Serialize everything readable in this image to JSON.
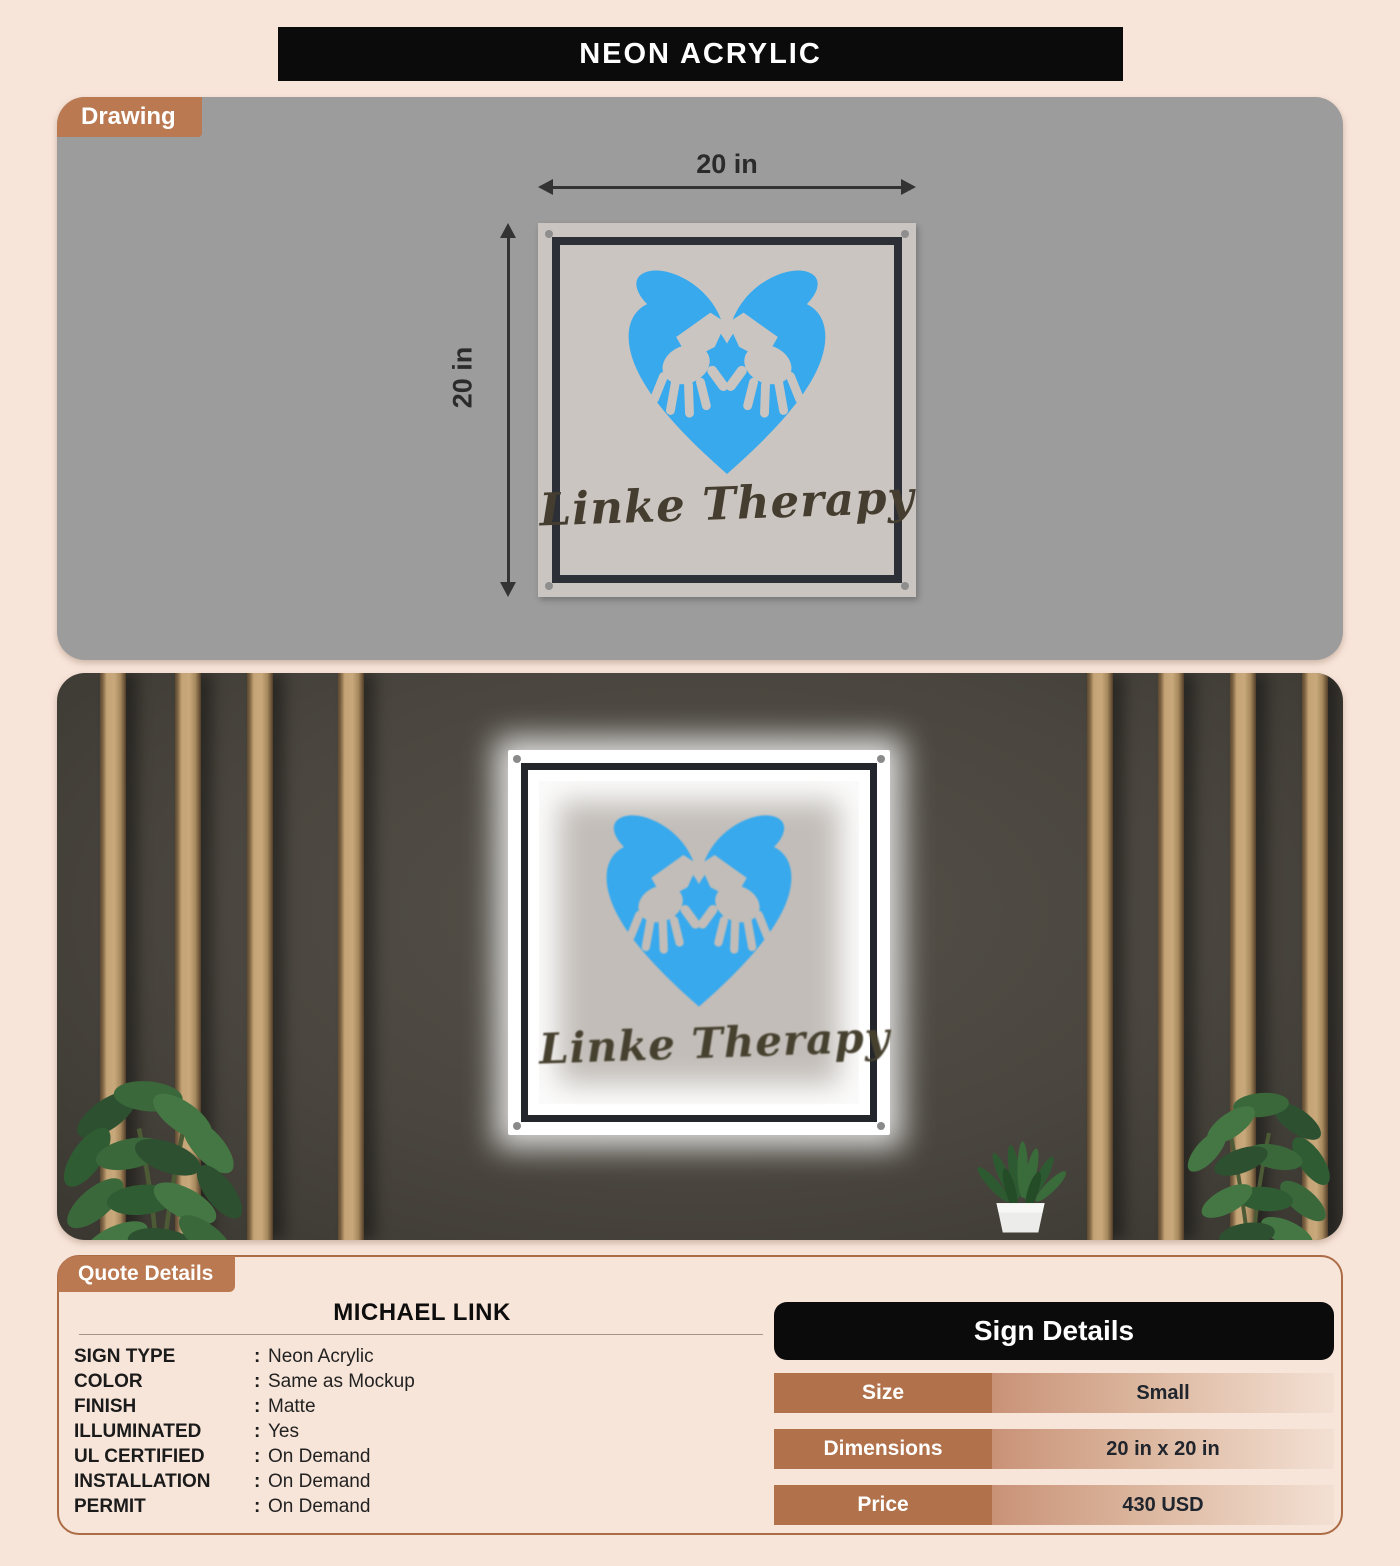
{
  "title": "NEON ACRYLIC",
  "drawing": {
    "tab_label": "Drawing",
    "width_dim": "20 in",
    "height_dim": "20 in"
  },
  "mockup": {
    "tab_label": "Mockup"
  },
  "sign": {
    "brand_text": "Linke Therapy"
  },
  "quote": {
    "tab_label": "Quote Details",
    "customer_name": "MICHAEL LINK",
    "colon": ":",
    "fields": [
      {
        "label": "SIGN TYPE",
        "value": "Neon Acrylic"
      },
      {
        "label": "COLOR",
        "value": "Same as Mockup"
      },
      {
        "label": "FINISH",
        "value": "Matte"
      },
      {
        "label": "ILLUMINATED",
        "value": "Yes"
      },
      {
        "label": "UL CERTIFIED",
        "value": "On Demand"
      },
      {
        "label": "INSTALLATION",
        "value": "On Demand"
      },
      {
        "label": "PERMIT",
        "value": "On Demand"
      }
    ]
  },
  "sign_details": {
    "header": "Sign Details",
    "rows": [
      {
        "label": "Size",
        "value": "Small"
      },
      {
        "label": "Dimensions",
        "value": "20 in x 20 in"
      },
      {
        "label": "Price",
        "value": "430 USD"
      }
    ]
  },
  "colors": {
    "accent_brown": "#bb7952",
    "logo_blue": "#38a9ed",
    "header_black": "#0b0b0b",
    "table_label_brown": "#b1724b",
    "page_background": "#f8e5d9"
  }
}
